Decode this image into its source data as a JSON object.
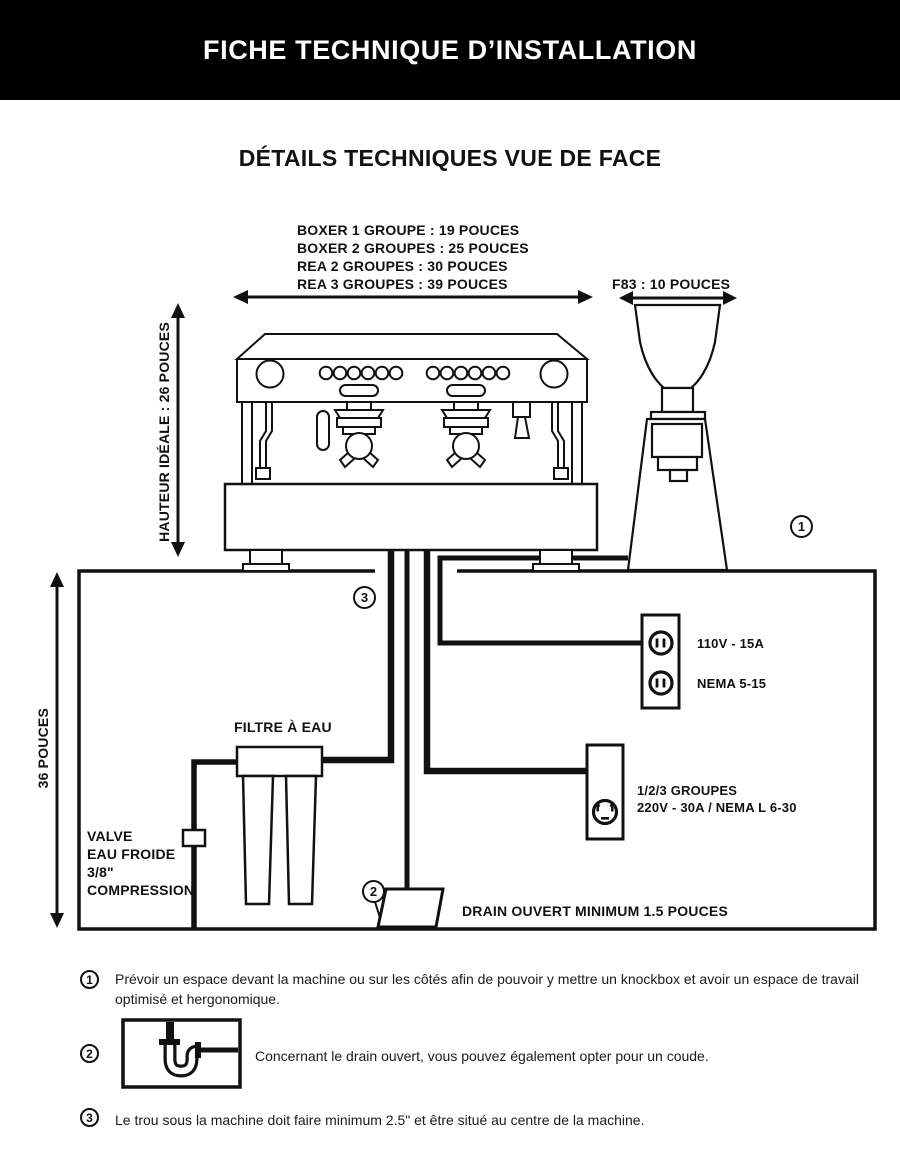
{
  "header": {
    "title": "FICHE TECHNIQUE D’INSTALLATION"
  },
  "section_title": "DÉTAILS TECHNIQUES VUE DE FACE",
  "dimensions": {
    "machine_widths": [
      "BOXER 1 GROUPE : 19 POUCES",
      "BOXER 2 GROUPES : 25 POUCES",
      "REA 2 GROUPES : 30 POUCES",
      "REA 3 GROUPES : 39 POUCES"
    ],
    "grinder_width": "F83 : 10 POUCES",
    "ideal_height": "HAUTEUR IDÉALE : 26 POUCES",
    "counter_height": "36 POUCES"
  },
  "plumbing": {
    "water_filter": "FILTRE À EAU",
    "valve_lines": [
      "VALVE",
      "EAU FROIDE",
      "3/8\"",
      "COMPRESSION"
    ],
    "drain": "DRAIN OUVERT MINIMUM 1.5 POUCES"
  },
  "electrical": {
    "outlet_110": {
      "spec": "110V - 15A",
      "nema": "NEMA 5-15"
    },
    "outlet_220": {
      "groups": "1/2/3 GROUPES",
      "spec": "220V - 30A / NEMA L 6-30"
    }
  },
  "callouts": {
    "one": "1",
    "two": "2",
    "three": "3"
  },
  "notes": [
    {
      "num": "1",
      "text": "Prévoir un espace devant la machine ou sur les côtés afin de pouvoir y mettre un knockbox et avoir un espace de travail optimisé et hergonomique."
    },
    {
      "num": "2",
      "text": "Concernant le drain ouvert, vous pouvez également opter pour un coude."
    },
    {
      "num": "3",
      "text": "Le trou sous la machine doit faire minimum 2.5\" et être situé au centre de la machine."
    }
  ],
  "colors": {
    "ink": "#111111",
    "header_bg": "#000000",
    "paper": "#ffffff"
  }
}
